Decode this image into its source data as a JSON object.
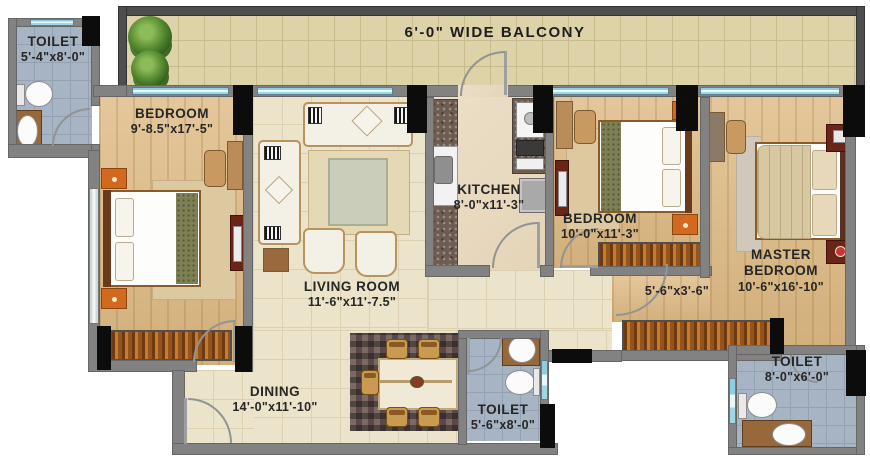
{
  "title": "Apartment Floor Plan",
  "balcony": {
    "label": "6'-0\" WIDE BALCONY"
  },
  "rooms": {
    "toilet_tl": {
      "name": "TOILET",
      "dims": "5'-4\"x8'-0\""
    },
    "bedroom1": {
      "name": "BEDROOM",
      "dims": "9'-8.5\"x17'-5\""
    },
    "living": {
      "name": "LIVING ROOM",
      "dims": "11'-6\"x11'-7.5\""
    },
    "kitchen": {
      "name": "KITCHEN",
      "dims": "8'-0\"x11'-3\""
    },
    "bedroom2": {
      "name": "BEDROOM",
      "dims": "10'-0\"x11'-3\""
    },
    "master": {
      "line1": "MASTER",
      "line2": "BEDROOM",
      "dims": "10'-6\"x16'-10\""
    },
    "passage": {
      "dims": "5'-6\"x3'-6\""
    },
    "dining": {
      "name": "DINING",
      "dims": "14'-0\"x11'-10\""
    },
    "toilet_mid": {
      "name": "TOILET",
      "dims": "5'-6\"x8'-0\""
    },
    "toilet_br": {
      "name": "TOILET",
      "dims": "8'-0\"x6'-0\""
    }
  },
  "colors": {
    "wall": "#828282",
    "outer_wall": "#4e4e4e",
    "column": "#0c0c0c",
    "wood_floor": "#dfbd89",
    "tile_floor": "#ece3cb",
    "balcony_tile": "#ddd2a8",
    "toilet_tile": "#a7b4c4",
    "wardrobe": "#c57c31",
    "window_glass": "#9fd6e4",
    "accent_furniture": "#d2691e",
    "label_text": "#262626"
  }
}
